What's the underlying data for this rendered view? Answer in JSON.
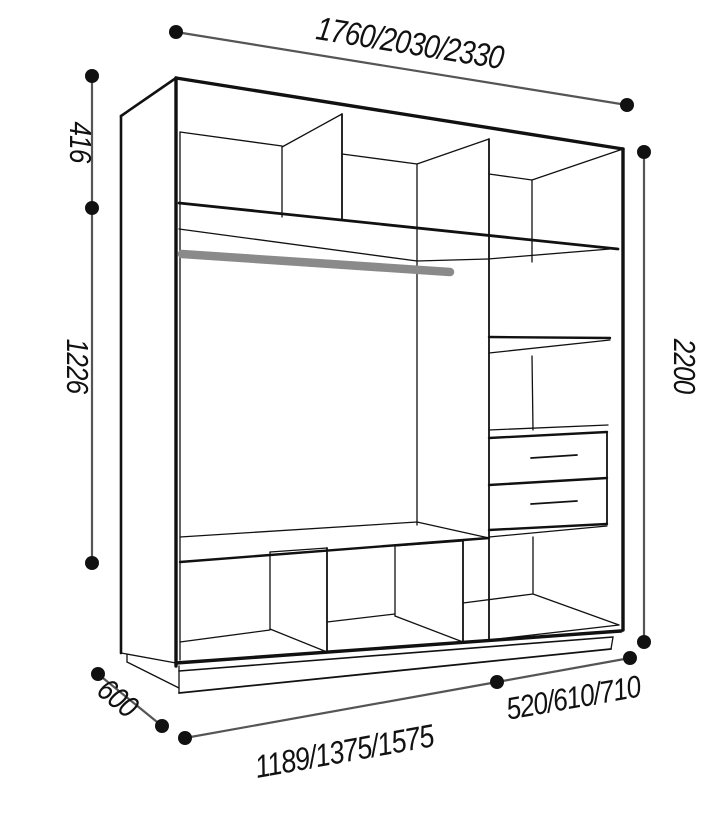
{
  "diagram": {
    "title": "wardrobe interior dimension drawing",
    "type": "furniture-technical-diagram",
    "dims": {
      "width_options_top": "1760/2030/2330",
      "total_height": "2200",
      "top_section_height": "416",
      "middle_section_height": "1226",
      "depth": "600",
      "bottom_width_left_options": "1189/1375/1575",
      "bottom_width_right_options": "520/610/710"
    },
    "features": {
      "hanging_rail": "gray clothes rail in middle section",
      "drawers": 2,
      "top_compartments": 3,
      "bottom_compartments": 3,
      "right_column_shelves": 2
    },
    "colors": {
      "line": "#111111",
      "dim_line": "#555555",
      "dot": "#111111",
      "rail": "#8a8a8a",
      "background": "#ffffff"
    }
  }
}
